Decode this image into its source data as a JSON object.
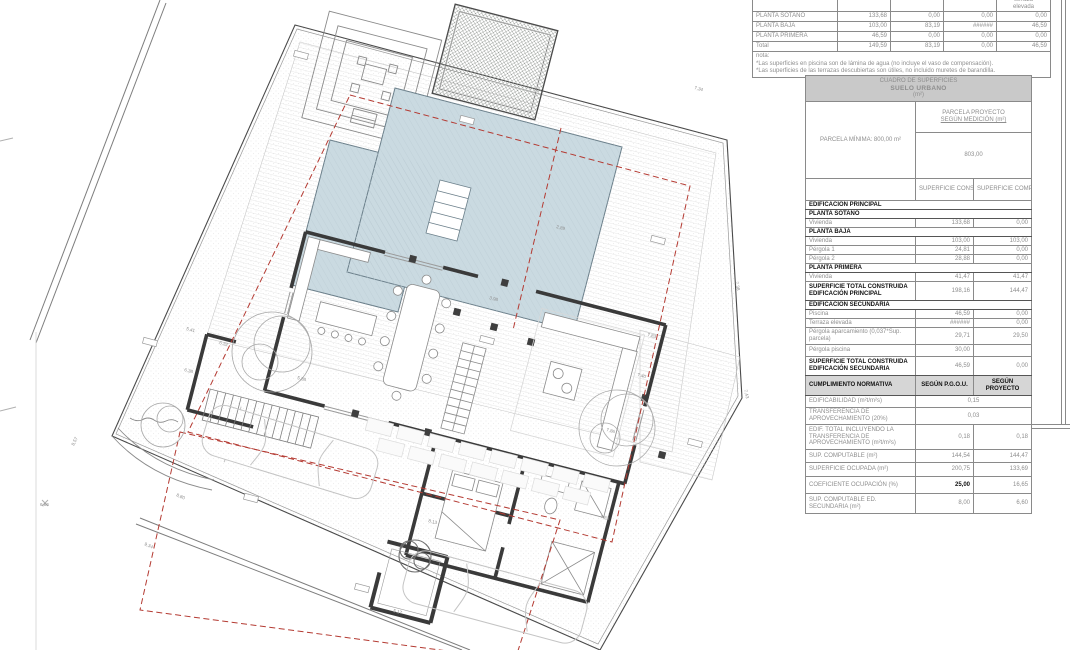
{
  "colors": {
    "pool_water": "#cadae1",
    "pool_edge": "#6b7f8a",
    "setback_red": "#b43a32",
    "wall_dark": "#3a3a3a",
    "table_header_bg": "#c9c9c9",
    "cad_text_gray": "#8e8e8e"
  },
  "summary_table": {
    "header_cols": [
      "",
      "",
      "",
      "",
      "terraza\nelevada"
    ],
    "rows": [
      {
        "label": "PLANTA SÓTANO",
        "values": [
          "133,68",
          "0,00",
          "0,00",
          "0,00"
        ]
      },
      {
        "label": "PLANTA BAJA",
        "values": [
          "103,00",
          "83,19",
          "######",
          "46,59"
        ]
      },
      {
        "label": "PLANTA PRIMERA",
        "values": [
          "46,59",
          "0,00",
          "0,00",
          "0,00"
        ]
      },
      {
        "label": "Total",
        "values": [
          "149,59",
          "83,19",
          "0,00",
          "46,59"
        ]
      }
    ],
    "nota_title": "nota:",
    "notes": [
      "*Las superficies en piscina son de lámina de agua (no incluye el vaso de compensación).",
      "*Las superficies de las terrazas descubiertas son útiles, no incluido muretes de barandilla."
    ]
  },
  "cuadro": {
    "title_line1": "CUADRO DE SUPERFICIES",
    "title_line2": "SUELO URBANO",
    "title_line3": "(m²)",
    "parcela_minima": "PARCELA MÍNIMA: 800,00 m²",
    "parcela_proyecto_line1": "PARCELA PROYECTO",
    "parcela_proyecto_line2": "SEGÚN MEDICIÓN (m²)",
    "parcela_proyecto_value": "803,00",
    "col_a": "SUPERFICIE\nCONSTRUIDA",
    "col_b": "SUPERFICIE\nCOMPUTABLE",
    "rows": [
      {
        "type": "sec",
        "h": 9,
        "label": "EDIFICACIÓN PRINCIPAL"
      },
      {
        "type": "sec",
        "h": 9,
        "label": "PLANTA SÓTANO"
      },
      {
        "type": "data",
        "h": 9,
        "label": "Vivienda",
        "a": "133,68",
        "b": "0,00"
      },
      {
        "type": "sec",
        "h": 9,
        "label": "PLANTA BAJA"
      },
      {
        "type": "data",
        "h": 9,
        "label": "Vivienda",
        "a": "103,00",
        "b": "103,00"
      },
      {
        "type": "data",
        "h": 9,
        "label": "Pérgola 1",
        "a": "24,81",
        "b": "0,00"
      },
      {
        "type": "data",
        "h": 9,
        "label": "Pérgola 2",
        "a": "28,88",
        "b": "0,00"
      },
      {
        "type": "sec",
        "h": 9,
        "label": "PLANTA PRIMERA"
      },
      {
        "type": "data",
        "h": 9,
        "label": "Vivienda",
        "a": "41,47",
        "b": "41,47"
      },
      {
        "type": "tot",
        "h": 19,
        "label": "SUPERFICIE TOTAL CONSTRUIDA EDIFICACIÓN PRINCIPAL",
        "a": "198,16",
        "b": "144,47"
      },
      {
        "type": "sec",
        "h": 9,
        "label": "EDIFICACIÓN SECUNDARIA"
      },
      {
        "type": "data",
        "h": 9,
        "label": "Piscina",
        "a": "46,59",
        "b": "0,00"
      },
      {
        "type": "data",
        "h": 9,
        "label": "Terraza elevada",
        "a": "######",
        "b": "0,00"
      },
      {
        "type": "data wrap",
        "h": 17,
        "label": "Pérgola aparcamiento (0,037*Sup. parcela)",
        "a": "29,71",
        "b": "29,50"
      },
      {
        "type": "data",
        "h": 12,
        "label": "Pérgola piscina",
        "a": "30,00",
        "b": ""
      },
      {
        "type": "tot",
        "h": 19,
        "label": "SUPERFICIE TOTAL CONSTRUIDA EDIFICACIÓN SECUNDARIA",
        "a": "46,59",
        "b": "0,00"
      },
      {
        "type": "normhdr",
        "h": 20,
        "label": "CUMPLIMIENTO NORMATIVA",
        "a": "SEGÚN P.G.O.U.",
        "b": "SEGÚN PROYECTO"
      },
      {
        "type": "norm merged",
        "h": 12,
        "label": "EDIFICABILIDAD      (m²t/m²s)",
        "v": "0,15"
      },
      {
        "type": "norm merged",
        "h": 17,
        "label": "TRANSFERENCIA DE APROVECHAMIENTO (20%)",
        "v": "0,03"
      },
      {
        "type": "norm",
        "h": 25,
        "label": "EDIF. TOTAL INCLUYENDO LA TRANSFERENCIA DE APROVECHAMIENTO   (m²t/m²s)",
        "a": "0,18",
        "b": "0,18"
      },
      {
        "type": "norm",
        "h": 13,
        "label": "SUP. COMPUTABLE      (m²)",
        "a": "144,54",
        "b": "144,47"
      },
      {
        "type": "norm",
        "h": 14,
        "label": "SUPERFICIE OCUPADA   (m²)",
        "a": "200,75",
        "b": "133,69"
      },
      {
        "type": "norm",
        "h": 17,
        "label": "COEFICIENTE OCUPACIÓN  (%)",
        "a": "25,00",
        "b": "16,65",
        "bold_a": true
      },
      {
        "type": "norm",
        "h": 20,
        "label": "SUP. COMPUTABLE ED. SECUNDARIA      (m²)",
        "a": "8,00",
        "b": "6,60"
      }
    ]
  },
  "plan": {
    "dim_labels": [
      {
        "t": "7,34",
        "x": 694,
        "y": 89,
        "r": 14.5
      },
      {
        "t": "7,38",
        "x": 735,
        "y": 282,
        "r": 76
      },
      {
        "t": "7,43",
        "x": 744,
        "y": 390,
        "r": 76
      },
      {
        "t": "2,89",
        "x": 556,
        "y": 228,
        "r": 14.5
      },
      {
        "t": "3,98",
        "x": 489,
        "y": 299,
        "r": 14.5
      },
      {
        "t": "7,83",
        "x": 647,
        "y": 336,
        "r": 14.5
      },
      {
        "t": "7,86",
        "x": 606,
        "y": 431,
        "r": 14.5
      },
      {
        "t": "7,40",
        "x": 637,
        "y": 376,
        "r": 14.5
      },
      {
        "t": "7,83",
        "x": 600,
        "y": 518,
        "r": 14.5
      },
      {
        "t": "5,88",
        "x": 297,
        "y": 379,
        "r": 14.5
      },
      {
        "t": "5,41",
        "x": 186,
        "y": 330,
        "r": 14.5
      },
      {
        "t": "6,32",
        "x": 219,
        "y": 344,
        "r": 14.5
      },
      {
        "t": "6,38",
        "x": 184,
        "y": 371,
        "r": 14.5
      },
      {
        "t": "8,57",
        "x": 74,
        "y": 446,
        "r": -64
      },
      {
        "t": "9,34",
        "x": 144,
        "y": 545,
        "r": 24
      },
      {
        "t": "8,80",
        "x": 176,
        "y": 496,
        "r": 24
      },
      {
        "t": "5,17",
        "x": 393,
        "y": 612,
        "r": 14.5
      },
      {
        "t": "8,13",
        "x": 428,
        "y": 522,
        "r": 14.5
      },
      {
        "t": "6,86",
        "x": 40,
        "y": 506,
        "r": 0
      }
    ]
  }
}
